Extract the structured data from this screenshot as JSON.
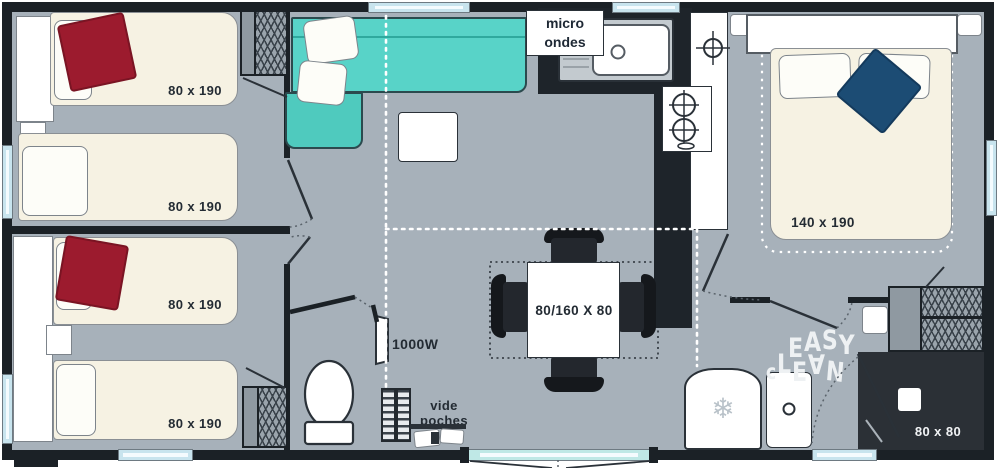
{
  "floorplan": {
    "type": "mobile-home floor plan",
    "bedroom_top_left": {
      "beds": [
        {
          "label": "80 x 190"
        },
        {
          "label": "80 x 190"
        }
      ]
    },
    "bedroom_bottom_left": {
      "beds": [
        {
          "label": "80 x 190"
        },
        {
          "label": "80 x 190"
        }
      ]
    },
    "bedroom_right": {
      "bed_label": "140 x 190"
    },
    "kitchen": {
      "microwave_label_line1": "micro",
      "microwave_label_line2": "ondes"
    },
    "dining": {
      "table_label": "80/160 X 80"
    },
    "entrance": {
      "heater_label": "1000W",
      "pocket_label_line1": "vide",
      "pocket_label_line2": "poches"
    },
    "bathroom": {
      "shower_label": "80 x 80",
      "brand_line1": [
        "E",
        "A",
        "S",
        "Y"
      ],
      "brand_line2": [
        "c",
        "L",
        "E",
        "∀",
        "N"
      ]
    }
  },
  "colors": {
    "wall": "#1b2126",
    "floor": "#a7b1ba",
    "bed_cream": "#f6f2e3",
    "sofa_teal": "#58d3c8",
    "blanket_red": "#9c1b2e",
    "blanket_navy": "#1c4c74",
    "window_blue": "#c8e4ee",
    "shower_dark": "#2b3036",
    "hatch_gray": "#9aa4ac"
  }
}
